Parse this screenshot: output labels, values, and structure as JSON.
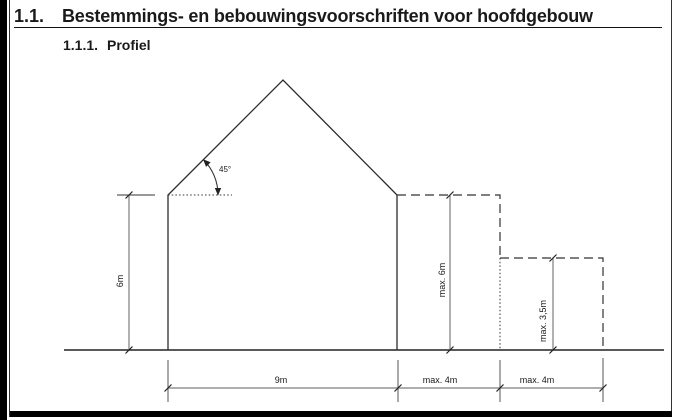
{
  "page": {
    "section_number": "1.1.",
    "section_title": "Bestemmings- en bebouwingsvoorschriften voor hoofdgebouw",
    "subsection_number": "1.1.1.",
    "subsection_title": "Profiel"
  },
  "diagram": {
    "roof_angle": "45°",
    "wall_height": "6m",
    "max_main_height": "max. 6m",
    "max_extension_height": "max. 3,5m",
    "main_width": "9m",
    "extension1_width": "max. 4m",
    "extension2_width": "max. 4m"
  },
  "colors": {
    "object_line": "#2b2b2b",
    "dimension_line": "#7d7d7d",
    "dashed_line": "#333333",
    "text": "#1a1a1a",
    "page_border": "#000000"
  }
}
